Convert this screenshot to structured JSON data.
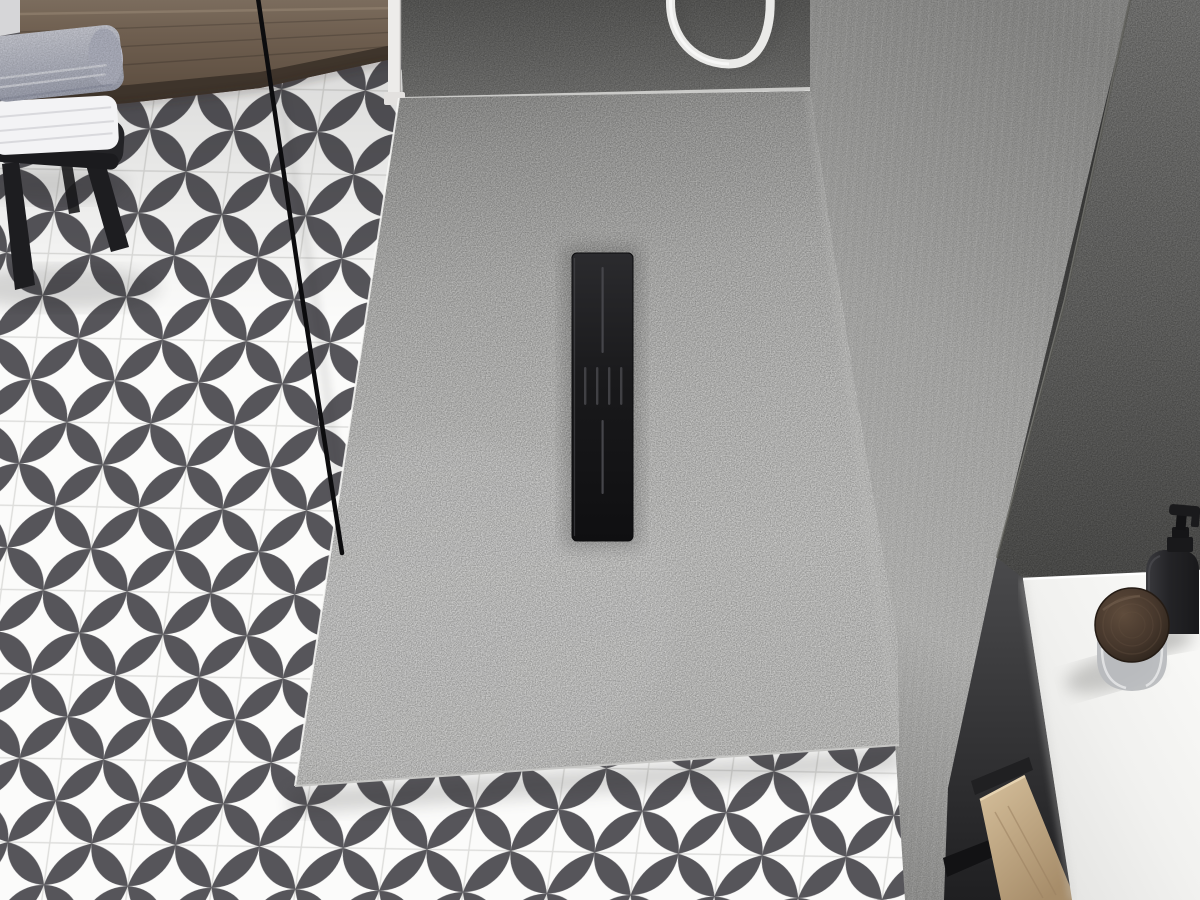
{
  "scene": {
    "description": "Top-down 3D render of a bathroom: white slate-textured rectangular shower tray with black linear drain, set into a black-and-white quatrefoil patterned tile floor, gray concrete walls, black-framed glass screen edge, wooden bench with towel stack on a black stool, hanging white shower hose, and a white vanity counter with black soap dispenser and wooden-lid glass jar.",
    "objects": [
      {
        "name": "floor-tiles",
        "label": "patterned tile floor"
      },
      {
        "name": "shower-tray",
        "label": "white stone shower tray"
      },
      {
        "name": "linear-drain",
        "label": "black linear drain cover"
      },
      {
        "name": "glass-frame-edge",
        "label": "black glass screen edge"
      },
      {
        "name": "wood-bench",
        "label": "wooden bench panel"
      },
      {
        "name": "towel-stack",
        "label": "folded towels"
      },
      {
        "name": "stool",
        "label": "black stool"
      },
      {
        "name": "shower-hose",
        "label": "white shower hose"
      },
      {
        "name": "back-wall",
        "label": "dark concrete back wall"
      },
      {
        "name": "side-wall-light",
        "label": "light concrete side wall"
      },
      {
        "name": "side-wall-dark",
        "label": "dark concrete right wall"
      },
      {
        "name": "vanity-counter",
        "label": "white counter top"
      },
      {
        "name": "soap-dispenser",
        "label": "black soap dispenser"
      },
      {
        "name": "wooden-jar",
        "label": "glass jar with wooden lid"
      },
      {
        "name": "wood-plank",
        "label": "oak vanity plank"
      }
    ]
  },
  "palette": {
    "tile_blade": "#4f4e53",
    "tile_bg": "#fbfbfa",
    "grout": "#dddddb",
    "tray_light": "#f4f4f2",
    "tray_shadow": "#b2b2b0",
    "drain_cover": "#1d1d1f",
    "drain_groove": "#45454a",
    "back_wall": "#787876",
    "wall_light": "#c7c7c5",
    "wall_dark": "#7e7e7c",
    "bench_wood": "#6f5f50",
    "bench_band": "#3c3229",
    "plank_wood": "#c2ab87",
    "towel_top": "#c5c8d6",
    "towel_white": "#f3f3f5",
    "stool": "#232326",
    "stool_leg": "#1d1d20",
    "counter": "#f2f2f0",
    "counter_edge": "#ffffff",
    "bottle": "#232325",
    "bottle_collar": "#19191b",
    "jar_lid": "#41332a",
    "jar_glass": "#b7babd",
    "hose": "#eaeae8",
    "glass_frame": "#0c0c0e",
    "trim_post": "#edecea",
    "frame_black": "#121214"
  }
}
